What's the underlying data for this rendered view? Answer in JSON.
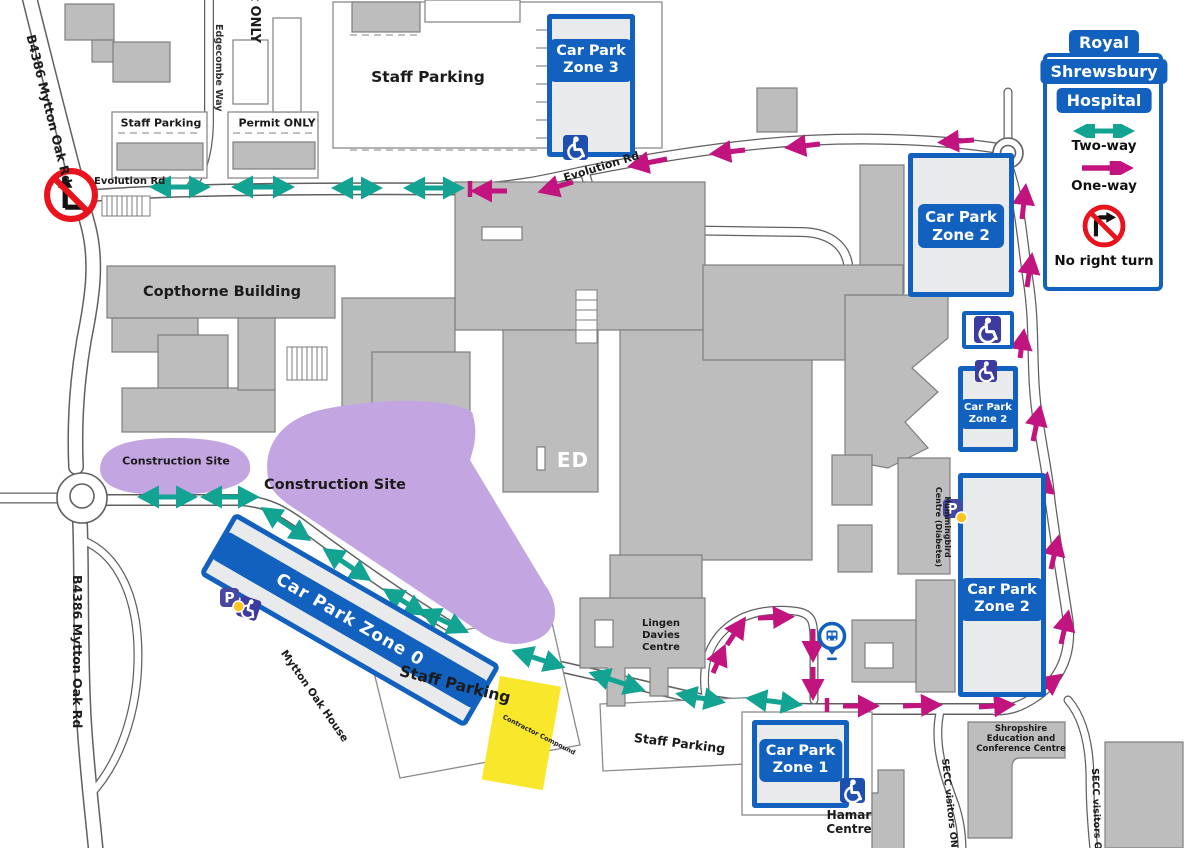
{
  "legend": {
    "title_lines": [
      "Royal",
      "Shrewsbury",
      "Hospital"
    ],
    "two_way": "Two-way",
    "one_way": "One-way",
    "no_right_turn": "No right turn"
  },
  "car_parks": {
    "zone3": {
      "line1": "Car Park",
      "line2": "Zone 3"
    },
    "zone2_main": {
      "line1": "Car Park",
      "line2": "Zone 2"
    },
    "zone2_small": {
      "line1": "Car Park",
      "line2": "Zone 2"
    },
    "zone2_south": {
      "line1": "Car Park",
      "line2": "Zone 2"
    },
    "zone1": {
      "line1": "Car Park",
      "line2": "Zone 1"
    },
    "zone0": {
      "label": "Car Park Zone 0"
    }
  },
  "roads": {
    "evolution_west": "Evolution Rd",
    "evolution_east": "Evolution Rd",
    "b4386_north": "B4386 Mytton Oak Rd",
    "b4386_south": "B4386 Mytton Oak Rd",
    "edgecombe_way": "Edgecombe Way",
    "secc_visitors_west": "SECC visitors ONLY",
    "secc_visitors_east": "SECC visitors ONLY"
  },
  "areas": {
    "staff_parking_north": "Staff Parking",
    "staff_parking_northwest": "Staff Parking",
    "permit_only": "Permit ONLY",
    "permit_only_vertical": "Permit ONLY",
    "staff_parking_southwest": "Staff Parking",
    "staff_parking_south": "Staff Parking",
    "construction_site_west": "Construction Site",
    "construction_site_main": "Construction Site",
    "contractor_compound": "Contractor Compound"
  },
  "buildings": {
    "copthorne": "Copthorne Building",
    "emergency_department": "ED",
    "mytton_oak_house": "Mytton Oak House",
    "lingen_davies": "Lingen Davies Centre",
    "hamar": "Hamar Centre",
    "hummingbird": "Hummingbird Centre (Diabetes)",
    "secc": "Shropshire Education and Conference Centre"
  },
  "icons": {
    "parking_letter": "P",
    "accessible_icon": "wheelchair",
    "bus_icon": "bus-stop"
  },
  "colors": {
    "blue": "#1261be",
    "teal": "#12a392",
    "magenta": "#c1147f",
    "red": "#e8131d",
    "purple": "#c3a5e1",
    "yellow": "#f8e72b",
    "building_gray": "#bdbdbd",
    "indigo": "#4747a1",
    "dot_yellow": "#ffc41f"
  }
}
